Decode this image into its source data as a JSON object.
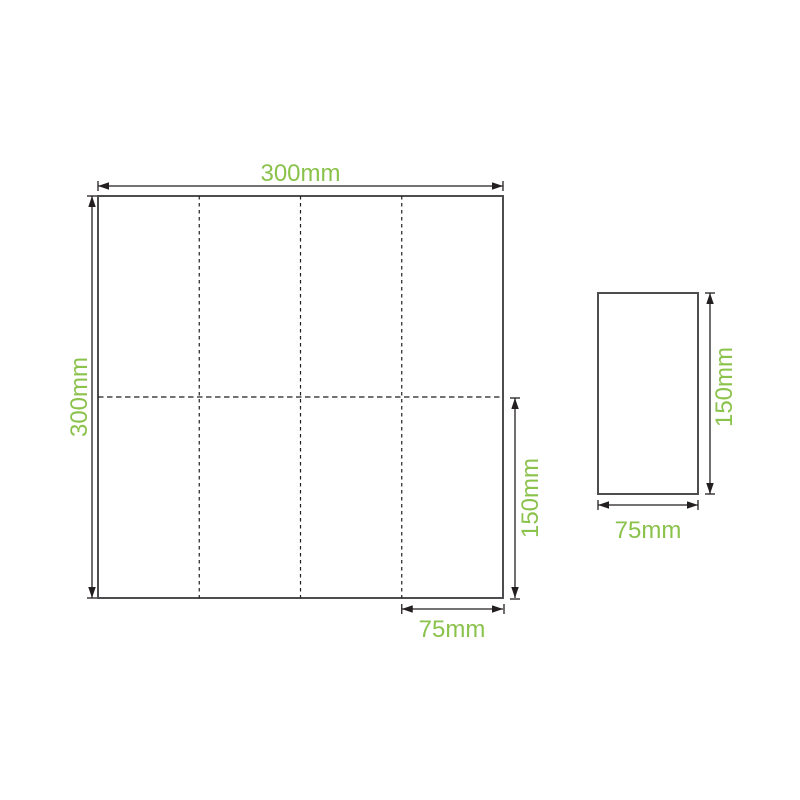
{
  "colors": {
    "accent_green": "#8bc24c",
    "line_black": "#231f20",
    "shape_gray": "#4d4d4f"
  },
  "unfolded_napkin": {
    "width_label": "300mm",
    "height_label": "300mm",
    "half_height_label": "150mm",
    "quarter_width_label": "75mm",
    "width_mm": 300,
    "height_mm": 300,
    "half_height_mm": 150,
    "quarter_width_mm": 75,
    "fold_columns": 4,
    "fold_rows": 2
  },
  "folded_napkin": {
    "height_label": "150mm",
    "width_label": "75mm",
    "height_mm": 150,
    "width_mm": 75
  }
}
